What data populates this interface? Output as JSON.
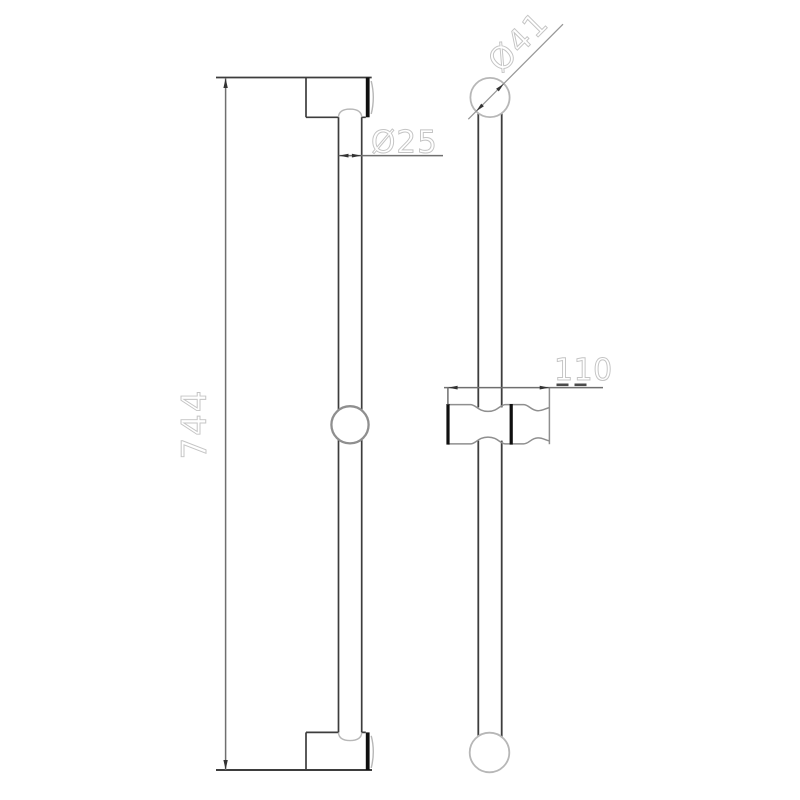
{
  "dimensions": {
    "overall_height": {
      "label": "744"
    },
    "bar_diameter": {
      "label": "Ø25"
    },
    "top_knob_diameter": {
      "label": "Ø41"
    },
    "holder_width": {
      "label": "110"
    }
  },
  "colors": {
    "background": "#ffffff",
    "object_line": "#3d3d3d",
    "object_line_bold": "#0f0f0f",
    "mid_line": "#8f8f8f",
    "light_line": "#b7b7b7",
    "dim_line": "#6f6f6f",
    "diag_dim_line": "#979797",
    "arrow": "#333333",
    "label_text": "#c4c4c4",
    "label_accent": "#4a4a4a"
  }
}
